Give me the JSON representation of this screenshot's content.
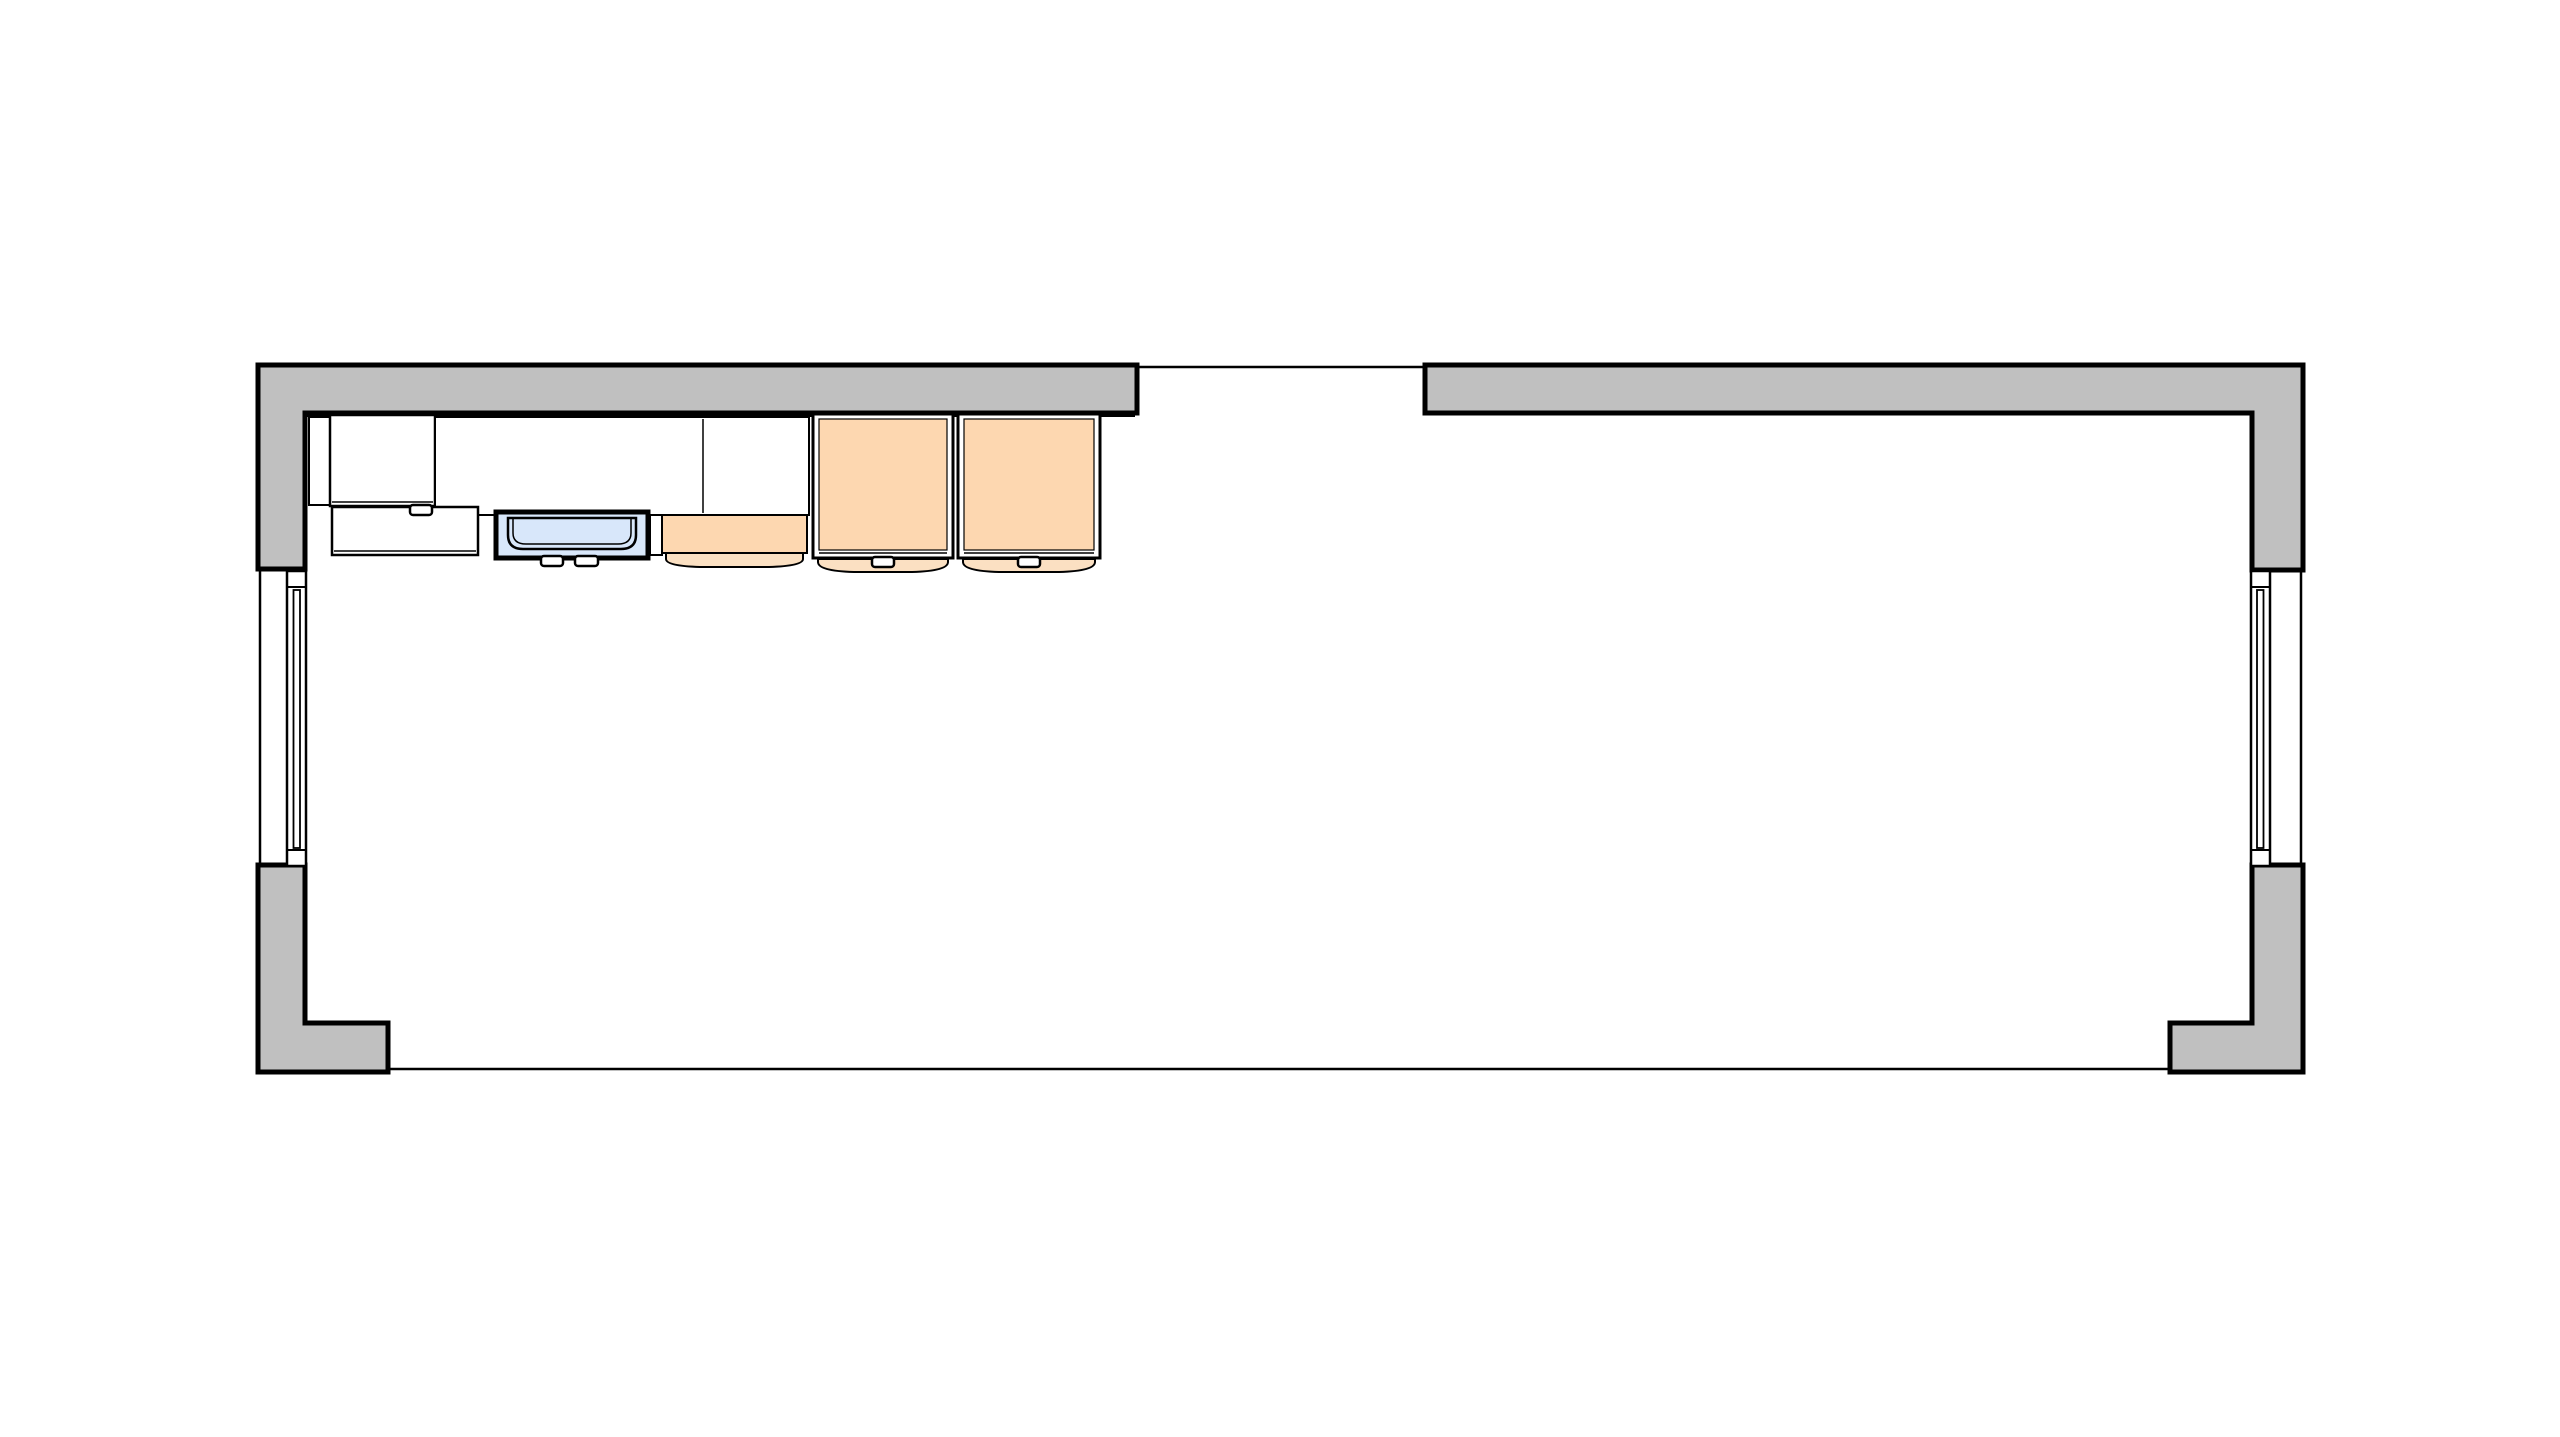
{
  "canvas": {
    "width": 2560,
    "height": 1437,
    "view": "top-down-floor-plan"
  },
  "colors": {
    "paper": "#ffffff",
    "wall": "#c0c0c0",
    "line": "#000000",
    "wood": "#fdd7b0",
    "woodLight": "#fbe0c2",
    "water": "#d8e7fa",
    "surface": "#ffffff"
  },
  "plan": {
    "walls": [
      {
        "id": "wall-top-left",
        "shape": "L",
        "cut_fill": "wall"
      },
      {
        "id": "wall-top-right",
        "shape": "L",
        "cut_fill": "wall"
      },
      {
        "id": "wall-bottom-left",
        "shape": "L",
        "cut_fill": "wall"
      },
      {
        "id": "wall-bottom-right",
        "shape": "L",
        "cut_fill": "wall"
      }
    ],
    "openings": [
      {
        "id": "door-opening-top",
        "type": "opening",
        "edge": "top"
      },
      {
        "id": "window-left",
        "type": "window",
        "edge": "left"
      },
      {
        "id": "window-right",
        "type": "window",
        "edge": "right"
      },
      {
        "id": "floor-section-line",
        "type": "section-line",
        "edge": "bottom"
      }
    ],
    "fixtures": [
      {
        "id": "upper-cabinet",
        "finish": "white"
      },
      {
        "id": "filler-panel",
        "finish": "white"
      },
      {
        "id": "countertop",
        "finish": "white"
      },
      {
        "id": "drawer-unit",
        "finish": "white"
      },
      {
        "id": "sink",
        "finish": "blue"
      },
      {
        "id": "bench-cabinet",
        "finish": "wood"
      },
      {
        "id": "tall-cabinet-1",
        "finish": "wood"
      },
      {
        "id": "tall-cabinet-2",
        "finish": "wood"
      }
    ]
  }
}
